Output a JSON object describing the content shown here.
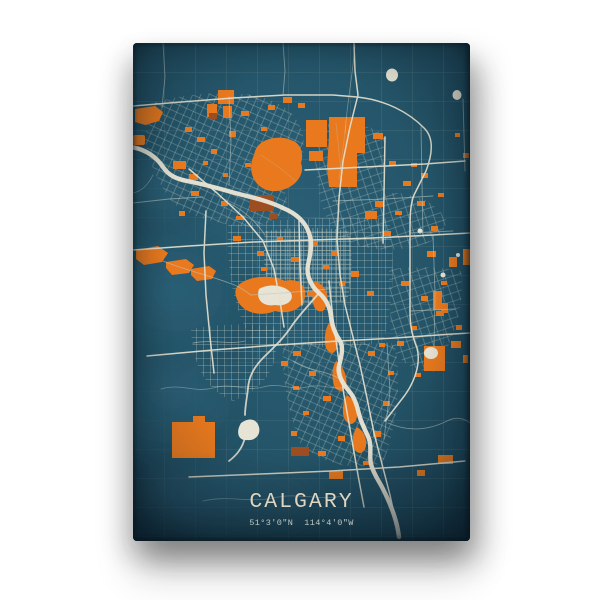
{
  "poster": {
    "title": "CALGARY",
    "coordinates": "51°3'0\"N  114°4'0\"W"
  },
  "map": {
    "style": "street-map-poster",
    "features": [
      "city streets",
      "parks and land-use patches",
      "river",
      "ring roads",
      "rural grid"
    ]
  },
  "colors": {
    "page_bg": "#ffffff",
    "map_teal": "#2a5f76",
    "map_teal_deep": "#1b4153",
    "accent_orange": "#ee7a1c",
    "accent_orange_dark": "#a04e1e",
    "road_light": "#e9e4d2",
    "road_dim": "#c0cdc5",
    "water": "#ece7d8",
    "title_text": "#ddd6c2",
    "coords_text": "#bdc9c0"
  }
}
